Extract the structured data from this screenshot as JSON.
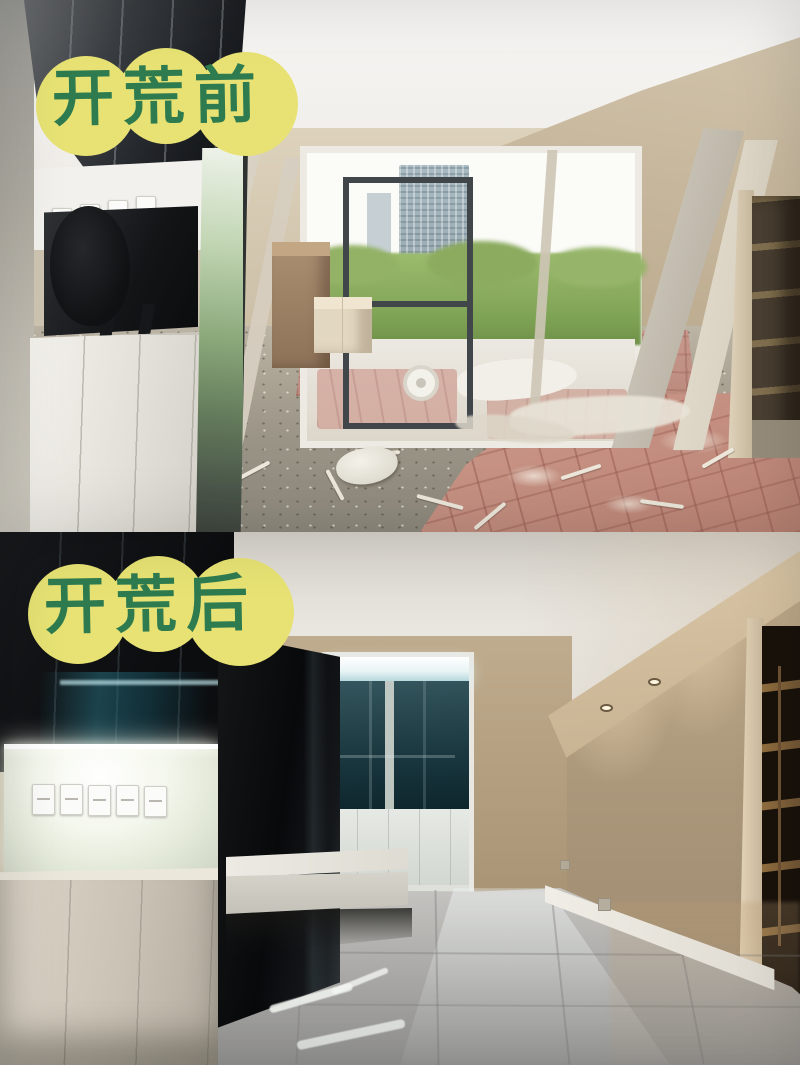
{
  "collage": {
    "kind": "before-after room cleaning comparison",
    "panels": [
      {
        "id": "before",
        "position": "top"
      },
      {
        "id": "after",
        "position": "bottom"
      }
    ]
  },
  "badges": {
    "before_label": "开荒前",
    "after_label": "开荒后"
  },
  "palette": {
    "badge_yellow": "#e7e273",
    "badge_green": "#2f7b50",
    "ceiling_before": "#f2f0ec",
    "wall_beige_before": "#c8b99f",
    "dark_cabinet": "#1c1f23",
    "foliage_green": "#86a95c",
    "building_grey": "#a3b4bc",
    "concrete_floor": "#9b9487",
    "red_floor_cover": "#c28f82",
    "ceiling_after": "#e7e4de",
    "wall_beige_after": "#b3a083",
    "black_gloss_panel": "#0c0e10",
    "teal_reflection": "#1f5560",
    "niche_glow": "#f6f9ee",
    "cream_cabinet": "#d3ccbe",
    "gloss_floor": "#a9a8a5",
    "balcony_glass_teal": "#1e3c44"
  }
}
